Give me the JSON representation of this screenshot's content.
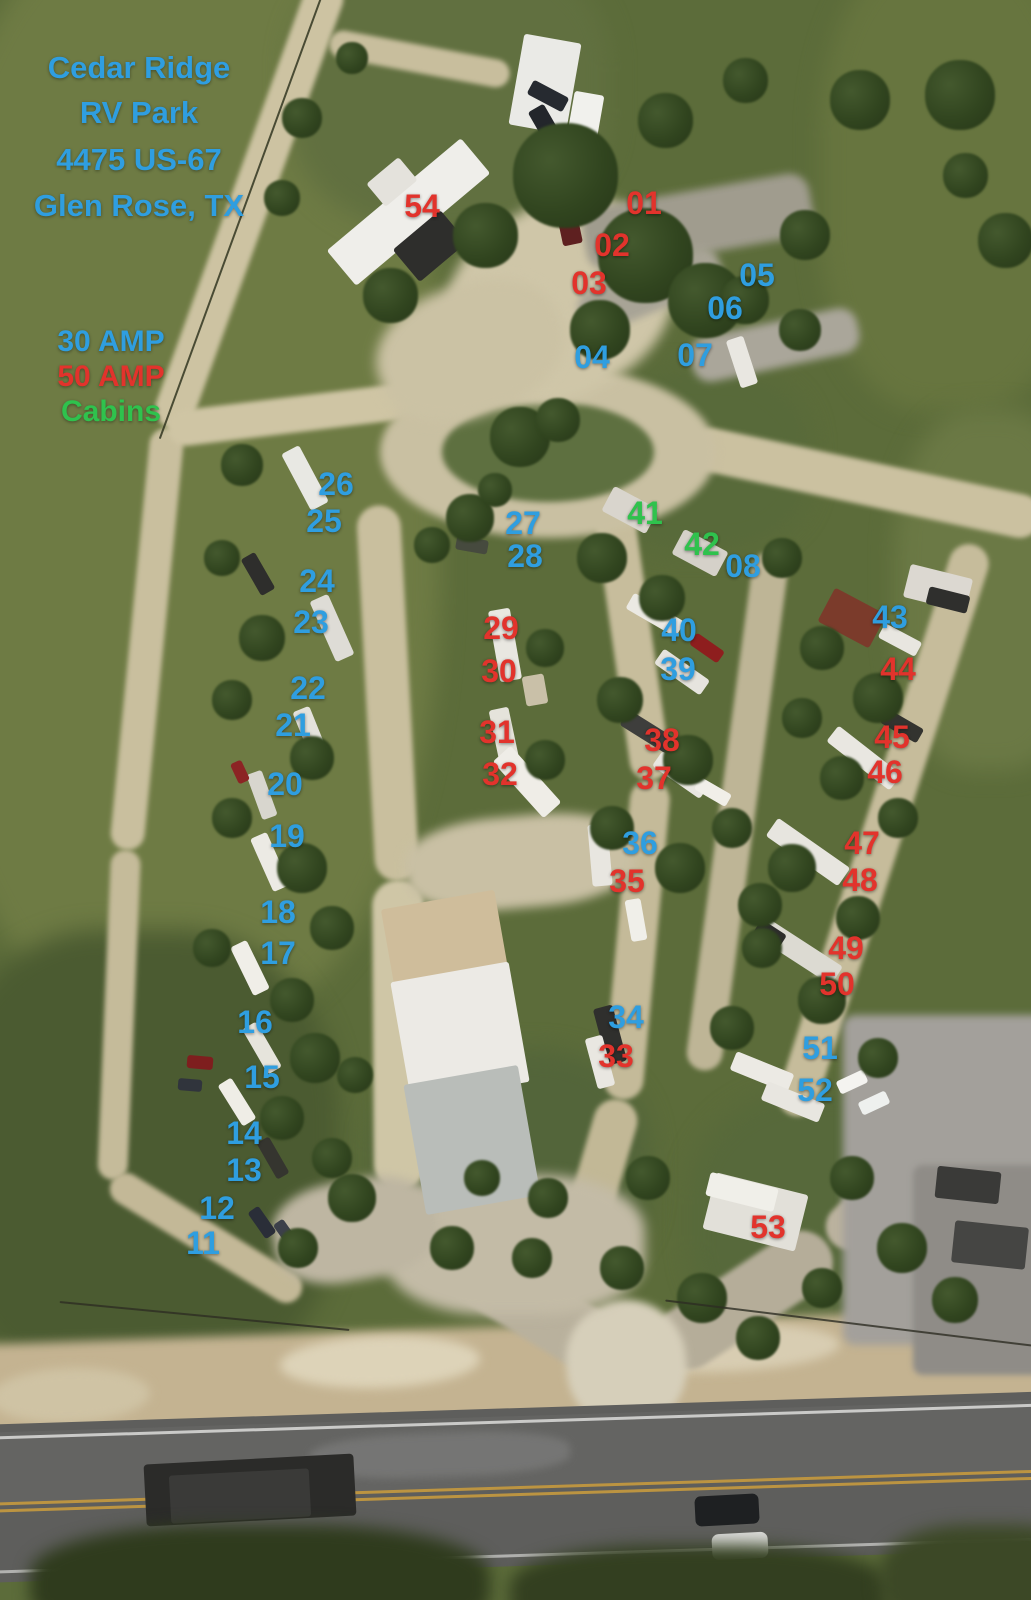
{
  "map_title": {
    "line1": "Cedar Ridge",
    "line2": "RV Park",
    "line3": "4475 US-67",
    "line4": "Glen Rose, TX"
  },
  "legend": {
    "items": [
      {
        "label": "30 AMP",
        "type": "amp30"
      },
      {
        "label": "50 AMP",
        "type": "amp50"
      },
      {
        "label": "Cabins",
        "type": "cabin"
      }
    ]
  },
  "colors": {
    "amp30": "#2F9EE0",
    "amp50": "#E2332C",
    "cabin": "#2FC24D"
  },
  "sites": [
    {
      "num": "01",
      "type": "amp50",
      "x": 644,
      "y": 203
    },
    {
      "num": "02",
      "type": "amp50",
      "x": 612,
      "y": 245
    },
    {
      "num": "03",
      "type": "amp50",
      "x": 589,
      "y": 283
    },
    {
      "num": "04",
      "type": "amp30",
      "x": 592,
      "y": 357
    },
    {
      "num": "05",
      "type": "amp30",
      "x": 757,
      "y": 275
    },
    {
      "num": "06",
      "type": "amp30",
      "x": 725,
      "y": 308
    },
    {
      "num": "07",
      "type": "amp30",
      "x": 695,
      "y": 355
    },
    {
      "num": "08",
      "type": "amp30",
      "x": 743,
      "y": 566
    },
    {
      "num": "11",
      "type": "amp30",
      "x": 203,
      "y": 1243
    },
    {
      "num": "12",
      "type": "amp30",
      "x": 217,
      "y": 1208
    },
    {
      "num": "13",
      "type": "amp30",
      "x": 244,
      "y": 1170
    },
    {
      "num": "14",
      "type": "amp30",
      "x": 244,
      "y": 1133
    },
    {
      "num": "15",
      "type": "amp30",
      "x": 262,
      "y": 1077
    },
    {
      "num": "16",
      "type": "amp30",
      "x": 255,
      "y": 1022
    },
    {
      "num": "17",
      "type": "amp30",
      "x": 278,
      "y": 953
    },
    {
      "num": "18",
      "type": "amp30",
      "x": 278,
      "y": 912
    },
    {
      "num": "19",
      "type": "amp30",
      "x": 287,
      "y": 836
    },
    {
      "num": "20",
      "type": "amp30",
      "x": 285,
      "y": 784
    },
    {
      "num": "21",
      "type": "amp30",
      "x": 293,
      "y": 725
    },
    {
      "num": "22",
      "type": "amp30",
      "x": 308,
      "y": 688
    },
    {
      "num": "23",
      "type": "amp30",
      "x": 311,
      "y": 622
    },
    {
      "num": "24",
      "type": "amp30",
      "x": 317,
      "y": 581
    },
    {
      "num": "25",
      "type": "amp30",
      "x": 324,
      "y": 521
    },
    {
      "num": "26",
      "type": "amp30",
      "x": 336,
      "y": 484
    },
    {
      "num": "27",
      "type": "amp30",
      "x": 523,
      "y": 523
    },
    {
      "num": "28",
      "type": "amp30",
      "x": 525,
      "y": 556
    },
    {
      "num": "29",
      "type": "amp50",
      "x": 501,
      "y": 628
    },
    {
      "num": "30",
      "type": "amp50",
      "x": 499,
      "y": 671
    },
    {
      "num": "31",
      "type": "amp50",
      "x": 497,
      "y": 732
    },
    {
      "num": "32",
      "type": "amp50",
      "x": 500,
      "y": 774
    },
    {
      "num": "33",
      "type": "amp50",
      "x": 616,
      "y": 1056
    },
    {
      "num": "34",
      "type": "amp30",
      "x": 626,
      "y": 1017
    },
    {
      "num": "35",
      "type": "amp50",
      "x": 627,
      "y": 881
    },
    {
      "num": "36",
      "type": "amp30",
      "x": 640,
      "y": 843
    },
    {
      "num": "37",
      "type": "amp50",
      "x": 654,
      "y": 778
    },
    {
      "num": "38",
      "type": "amp50",
      "x": 662,
      "y": 740
    },
    {
      "num": "39",
      "type": "amp30",
      "x": 678,
      "y": 669
    },
    {
      "num": "40",
      "type": "amp30",
      "x": 679,
      "y": 630
    },
    {
      "num": "41",
      "type": "cabin",
      "x": 645,
      "y": 513
    },
    {
      "num": "42",
      "type": "cabin",
      "x": 702,
      "y": 544
    },
    {
      "num": "43",
      "type": "amp30",
      "x": 890,
      "y": 617
    },
    {
      "num": "44",
      "type": "amp50",
      "x": 898,
      "y": 669
    },
    {
      "num": "45",
      "type": "amp50",
      "x": 892,
      "y": 737
    },
    {
      "num": "46",
      "type": "amp50",
      "x": 885,
      "y": 772
    },
    {
      "num": "47",
      "type": "amp50",
      "x": 862,
      "y": 843
    },
    {
      "num": "48",
      "type": "amp50",
      "x": 860,
      "y": 880
    },
    {
      "num": "49",
      "type": "amp50",
      "x": 846,
      "y": 948
    },
    {
      "num": "50",
      "type": "amp50",
      "x": 837,
      "y": 984
    },
    {
      "num": "51",
      "type": "amp30",
      "x": 820,
      "y": 1048
    },
    {
      "num": "52",
      "type": "amp30",
      "x": 815,
      "y": 1090
    },
    {
      "num": "53",
      "type": "amp50",
      "x": 768,
      "y": 1227
    },
    {
      "num": "54",
      "type": "amp50",
      "x": 422,
      "y": 206
    }
  ]
}
